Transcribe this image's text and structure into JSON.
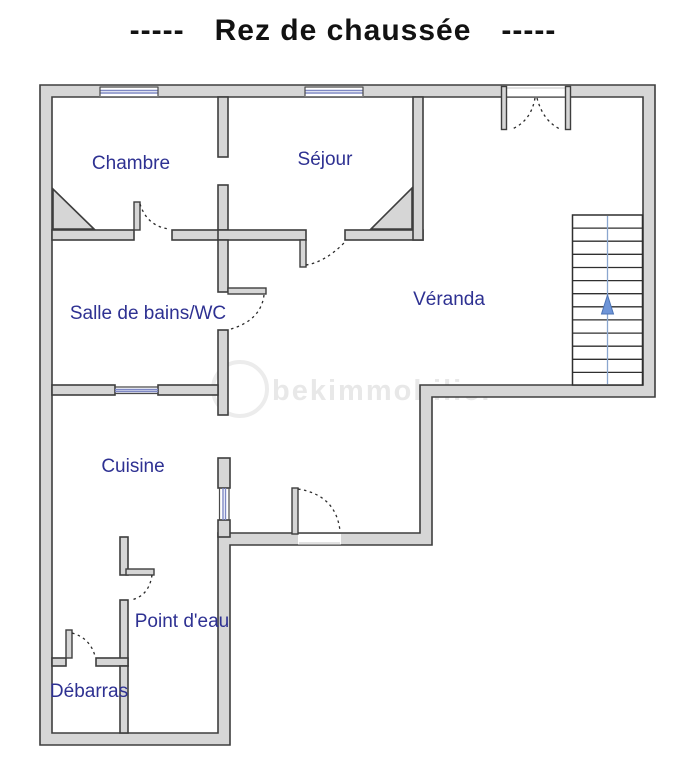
{
  "title": {
    "prefix": "-----",
    "text": "Rez de chaussée",
    "suffix": "-----"
  },
  "floorplan": {
    "rooms": [
      {
        "id": "chambre",
        "label": "Chambre"
      },
      {
        "id": "sejour",
        "label": "Séjour"
      },
      {
        "id": "salle-de-bains",
        "label": "Salle de bains/WC"
      },
      {
        "id": "veranda",
        "label": "Véranda"
      },
      {
        "id": "cuisine",
        "label": "Cuisine"
      },
      {
        "id": "point-deau",
        "label": "Point d'eau"
      },
      {
        "id": "debarras",
        "label": "Débarras"
      }
    ],
    "stairs": {
      "treads": 13,
      "direction_arrow": "up"
    },
    "features": {
      "windows": 4,
      "single_doors": 6,
      "double_entry_door": true,
      "chimney_corners": 2
    }
  },
  "watermark": {
    "text": "bekimmobilier"
  },
  "colors": {
    "wall_fill": "#d6d6d6",
    "wall_outline": "#3e3e3e",
    "room_label": "#2e3192",
    "window_glass": "#7e88c4",
    "stair_arrow": "#6e95d8",
    "stair_guide": "#8aa6cf",
    "watermark": "#e8e8e8",
    "title_color": "#121212"
  }
}
